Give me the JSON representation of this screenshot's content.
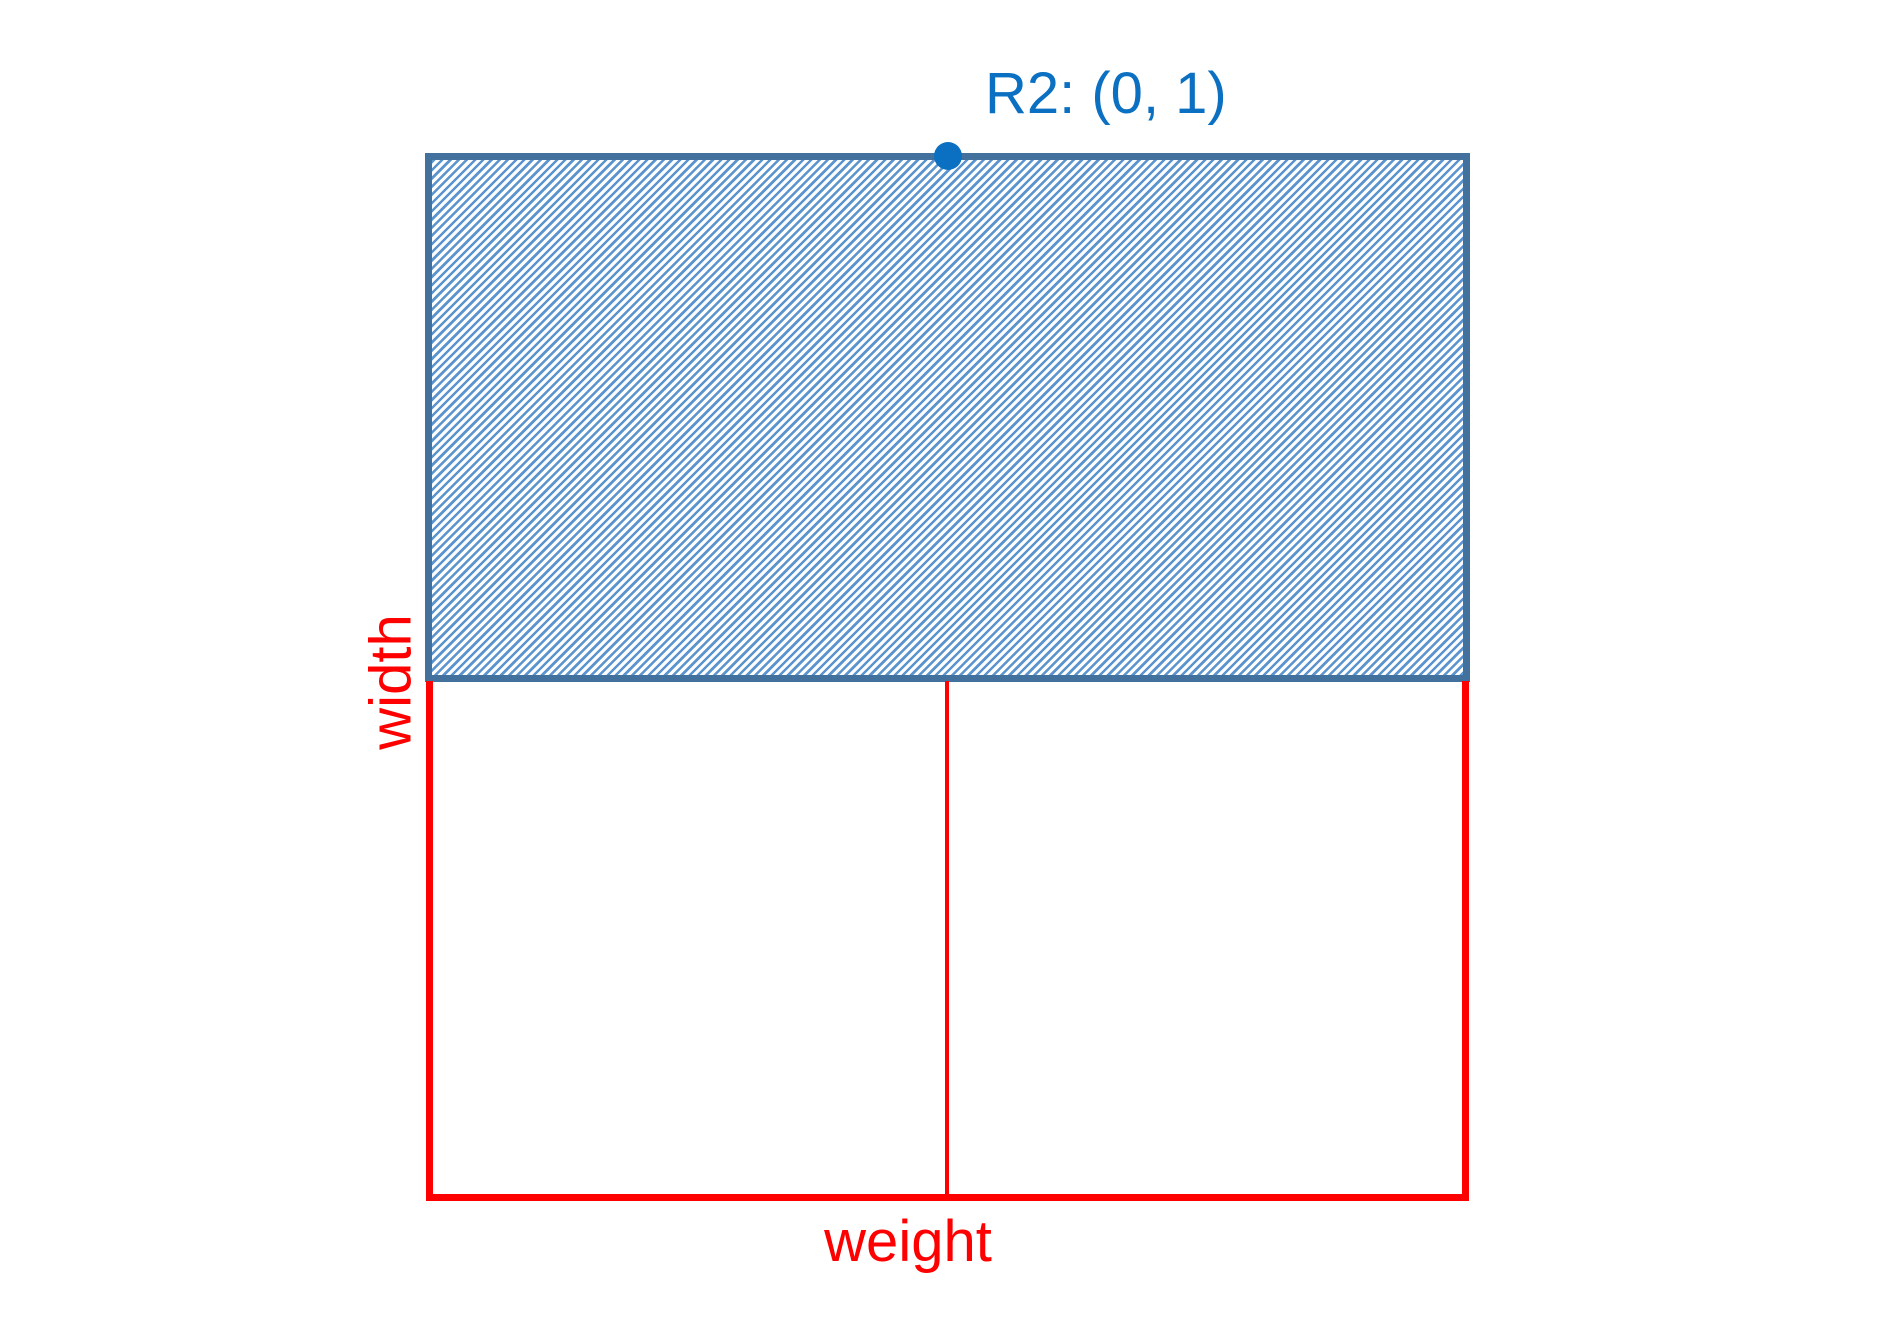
{
  "colors": {
    "axis_red": "#ff0000",
    "region_border_blue": "#41719c",
    "region_stripe_blue": "#5b94cf",
    "point_blue": "#0b70c1",
    "background": "#ffffff"
  },
  "diagram": {
    "region": {
      "name": "R2",
      "hatched": true,
      "point_label": "R2: (0, 1)",
      "point_coords": "(0, 1)"
    },
    "axes": {
      "x_label": "weight",
      "y_label": "width"
    }
  }
}
